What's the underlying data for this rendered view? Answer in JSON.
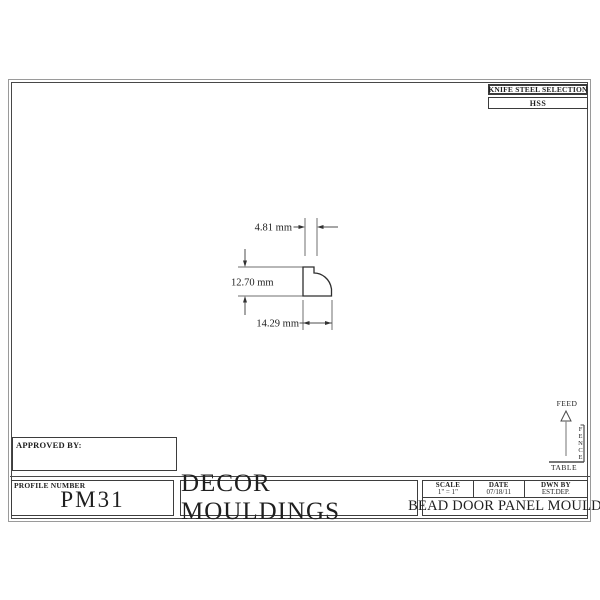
{
  "colors": {
    "ink": "#1f1f1f",
    "line_gray": "#4d4d4d"
  },
  "knife_block": {
    "title": "KNIFE STEEL SELECTION",
    "value": "HSS"
  },
  "profile_drawing": {
    "top_width_dim": "4.81 mm",
    "height_dim": "12.70 mm",
    "bottom_width_dim": "14.29 mm"
  },
  "machine_diagram": {
    "feed_label": "FEED",
    "fence_label": "FENCE",
    "table_label": "TABLE"
  },
  "title_block": {
    "approved_by_label": "APPROVED BY:",
    "profile_number_label": "PROFILE NUMBER",
    "profile_number": "PM31",
    "company_name": "DECOR MOULDINGS",
    "scale_label": "SCALE",
    "scale_value": "1\" = 1\"",
    "date_label": "DATE",
    "date_value": "07/18/11",
    "drawn_by_label": "DWN BY",
    "drawn_by_value": "EST.DEP.",
    "drawing_title": "BEAD DOOR PANEL MOULD"
  }
}
